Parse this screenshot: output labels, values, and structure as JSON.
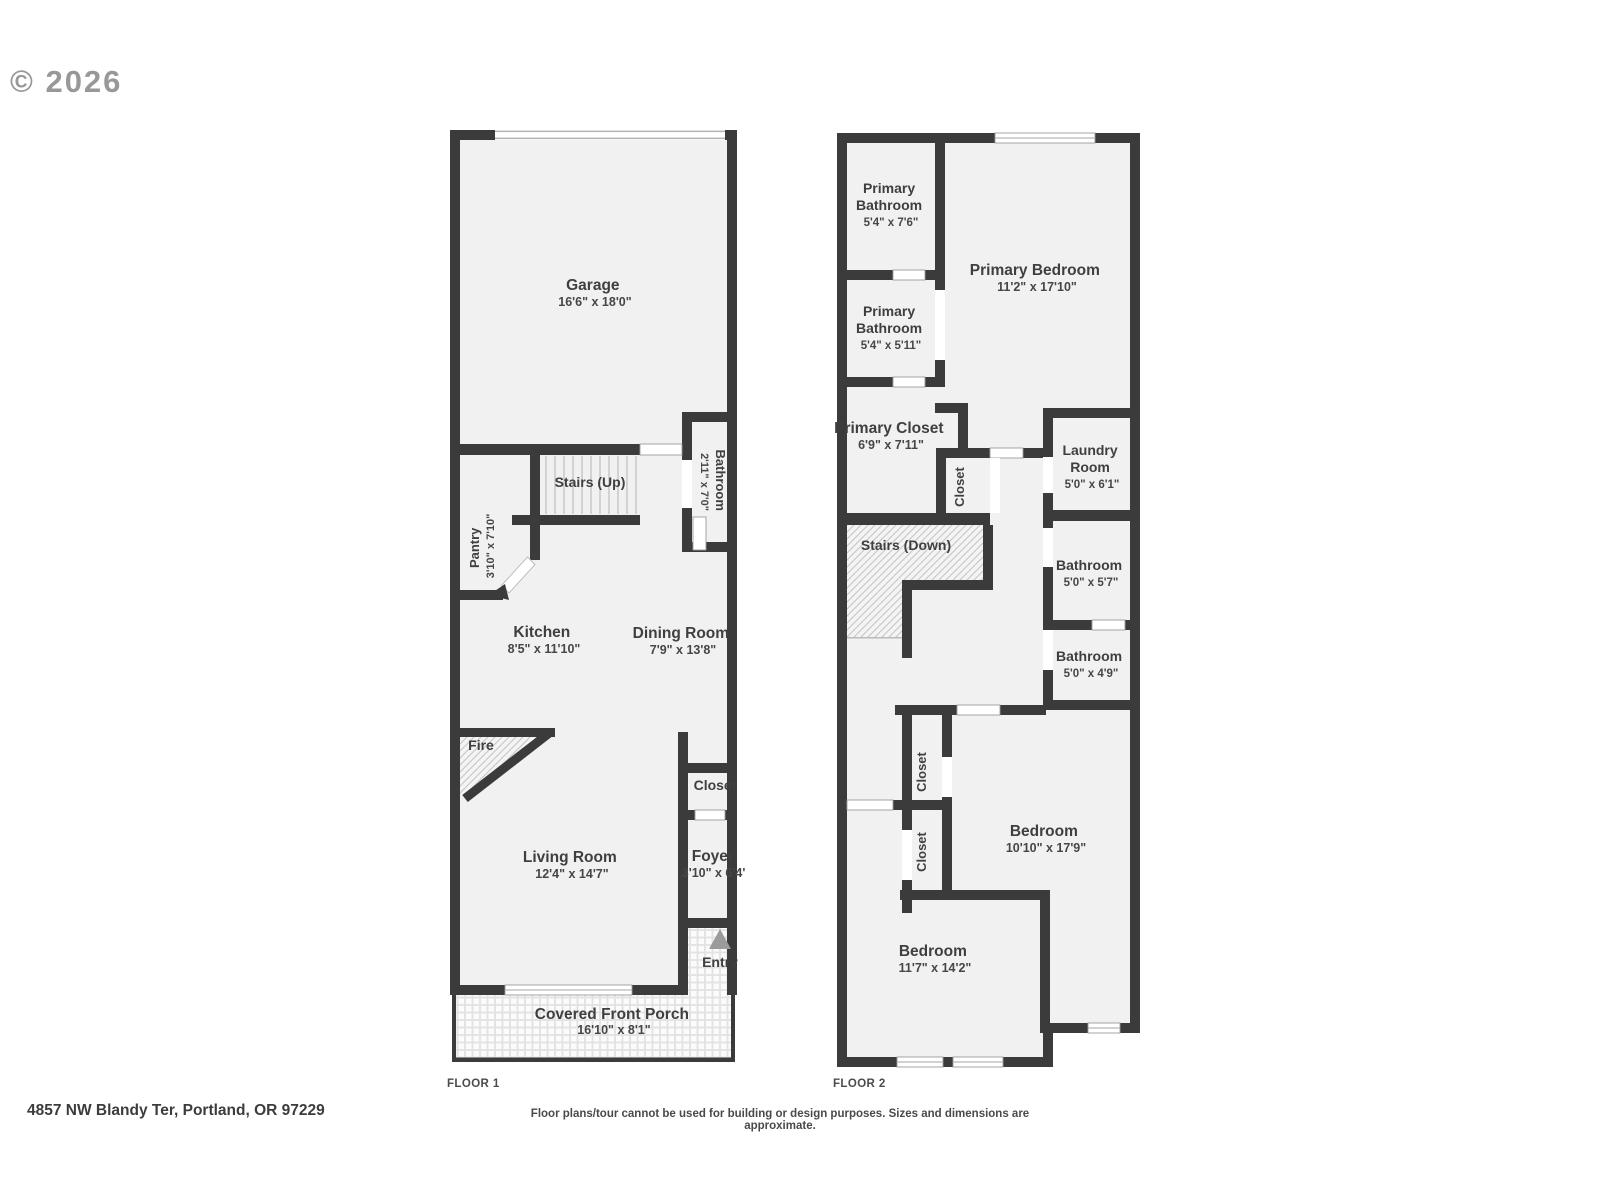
{
  "copyright": "© 2026",
  "colors": {
    "wall": "#3b3b3b",
    "room_fill": "#f1f1f1",
    "label_text": "#3f3f3f",
    "muted_text": "#8d8d8d",
    "hairline": "#9c9c9c"
  },
  "f1": {
    "label": "FLOOR 1",
    "rooms": {
      "garage": {
        "name": "Garage",
        "dims": "16'6\" x 18'0\""
      },
      "stairs": {
        "name": "Stairs (Up)"
      },
      "pantry": {
        "name": "Pantry",
        "dims": "3'10\" x 7'10\""
      },
      "bathroom": {
        "name": "Bathroom",
        "dims": "2'11\" x 7'0\""
      },
      "kitchen": {
        "name": "Kitchen",
        "dims": "8'5\" x 11'10\""
      },
      "dining": {
        "name": "Dining Room",
        "dims": "7'9\" x 13'8\""
      },
      "fire": {
        "name": "Fire"
      },
      "closet": {
        "name": "Closet"
      },
      "living": {
        "name": "Living Room",
        "dims": "12'4\" x 14'7\""
      },
      "foyer": {
        "name": "Foyer",
        "dims": "3'10\" x 6'4\""
      },
      "entry": {
        "name": "Entry"
      },
      "porch": {
        "name": "Covered Front Porch",
        "dims": "16'10\" x 8'1\""
      }
    }
  },
  "f2": {
    "label": "FLOOR 2",
    "rooms": {
      "pbath1": {
        "line1": "Primary",
        "line2": "Bathroom",
        "dims": "5'4\" x 7'6\""
      },
      "pbath2": {
        "line1": "Primary",
        "line2": "Bathroom",
        "dims": "5'4\" x 5'11\""
      },
      "pbed": {
        "name": "Primary Bedroom",
        "dims": "11'2\" x 17'10\""
      },
      "pcloset": {
        "name": "Primary Closet",
        "dims": "6'9\" x 7'11\""
      },
      "hallcloset": {
        "name": "Closet"
      },
      "laundry": {
        "line1": "Laundry",
        "line2": "Room",
        "dims": "5'0\" x 6'1\""
      },
      "stairs": {
        "name": "Stairs (Down)"
      },
      "bath1": {
        "name": "Bathroom",
        "dims": "5'0\" x 5'7\""
      },
      "bath2": {
        "name": "Bathroom",
        "dims": "5'0\" x 4'9\""
      },
      "closet1": {
        "name": "Closet"
      },
      "closet2": {
        "name": "Closet"
      },
      "bedroom_r": {
        "name": "Bedroom",
        "dims": "10'10\" x 17'9\""
      },
      "bedroom_b": {
        "name": "Bedroom",
        "dims": "11'7\" x 14'2\""
      }
    }
  },
  "footer": {
    "address": "4857 NW Blandy Ter, Portland, OR 97229",
    "disclaimer": "Floor plans/tour cannot be used for building or design purposes. Sizes and dimensions are approximate."
  }
}
